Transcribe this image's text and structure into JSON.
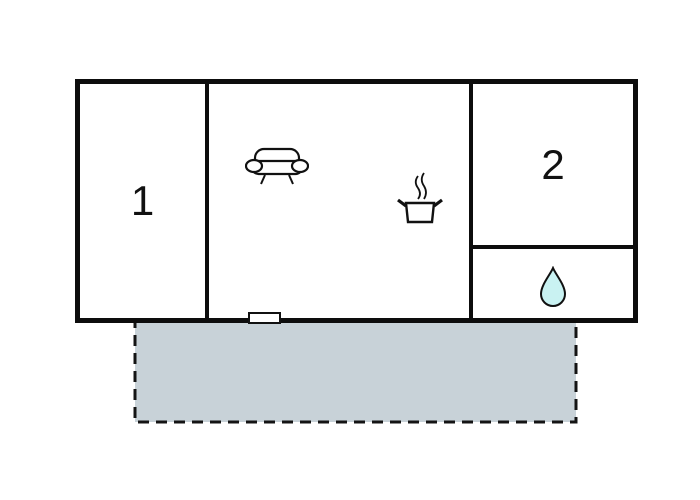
{
  "floorplan": {
    "rooms": [
      {
        "id": "room-1",
        "label": "1"
      },
      {
        "id": "room-2",
        "label": "2"
      }
    ],
    "icons": [
      {
        "name": "sofa-icon"
      },
      {
        "name": "cooking-pot-icon"
      },
      {
        "name": "water-drop-icon"
      }
    ],
    "features": [
      {
        "name": "entrance-marker"
      },
      {
        "name": "terrace"
      }
    ]
  },
  "colors": {
    "wall": "#0d0d0d",
    "background": "#ffffff",
    "terrace_fill": "#c8d2d8",
    "terrace_stroke": "#141414",
    "drop_fill": "#c9f2f2",
    "icon_stroke": "#111111"
  }
}
